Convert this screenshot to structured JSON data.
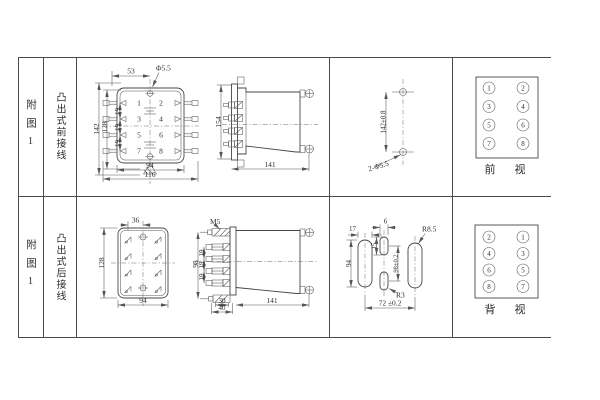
{
  "sheet": {
    "row1": {
      "figure_label": "附图1",
      "wiring_type": "凸出式前接线",
      "front_view": {
        "dim_top_width": "53",
        "hole_callout": "Φ5.5",
        "dim_height_outer": "142",
        "dim_height_inner": "128",
        "pitch_a": "19",
        "pitch_b": "19",
        "pitch_c": "19",
        "dim_body_width": "94",
        "dim_overall_width": "116",
        "pins": [
          "1",
          "2",
          "3",
          "4",
          "5",
          "6",
          "7",
          "8"
        ]
      },
      "side_view": {
        "dim_height": "154",
        "dim_depth": "141"
      },
      "drill_plan": {
        "hole_spacing": "142±0.8",
        "hole_callout": "2-Φ5.5"
      },
      "terminal_view": {
        "label": "前　视",
        "left_column": [
          "1",
          "3",
          "5",
          "7"
        ],
        "right_column": [
          "2",
          "4",
          "6",
          "8"
        ]
      }
    },
    "row2": {
      "figure_label": "附图1",
      "wiring_type": "凸出式后接线",
      "body_view": {
        "dim_center_offset": "36",
        "dim_height": "128",
        "dim_width": "94"
      },
      "side_view": {
        "stud_label": "M5",
        "dim_stud_span": "98",
        "pitch_a": "19",
        "pitch_b": "19",
        "pitch_c": "19",
        "dim_stub_inner": "30",
        "dim_stub_outer": "40",
        "dim_depth": "141"
      },
      "cutout_plan": {
        "dim_slot_width": "17",
        "dim_slot_length": "94",
        "dim_small_width": "6",
        "dim_small_length": "15",
        "radius_large": "R8.5",
        "radius_small": "R3",
        "dim_vertical_spacing": "98±0.2",
        "dim_horizontal_spacing": "72 ±0.2"
      },
      "terminal_view": {
        "label": "背　视",
        "left_column": [
          "2",
          "4",
          "6",
          "8"
        ],
        "right_column": [
          "1",
          "3",
          "5",
          "7"
        ]
      }
    }
  }
}
